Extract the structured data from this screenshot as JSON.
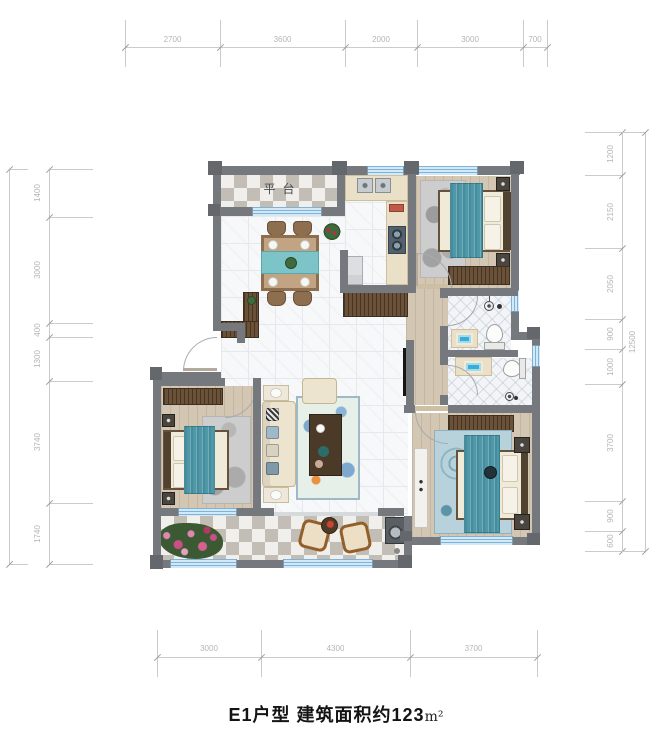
{
  "title": {
    "main": "E1户型 建筑面积约123",
    "unit": "m²"
  },
  "rooms": {
    "terrace": "平台"
  },
  "dimensions": {
    "top": [
      "2700",
      "3600",
      "2000",
      "3000",
      "700"
    ],
    "bottom": [
      "3000",
      "4300",
      "3700"
    ],
    "left": [
      "1400",
      "3000",
      "400",
      "1300",
      "3740",
      "1740"
    ],
    "left_total": [
      "11580"
    ],
    "right": [
      "1200",
      "2150",
      "2050",
      "900",
      "1000",
      "3700",
      "900",
      "600"
    ],
    "right_total": [
      "12500"
    ]
  },
  "colors": {
    "wall": "#75787c",
    "window": "#d2eaf8",
    "window_stripe": "#7fb2d6",
    "bed_teal": "#4f98a8",
    "furniture_wood": "#6a5138",
    "dimension_text": "#b5b5b5",
    "title_text": "#141414"
  }
}
